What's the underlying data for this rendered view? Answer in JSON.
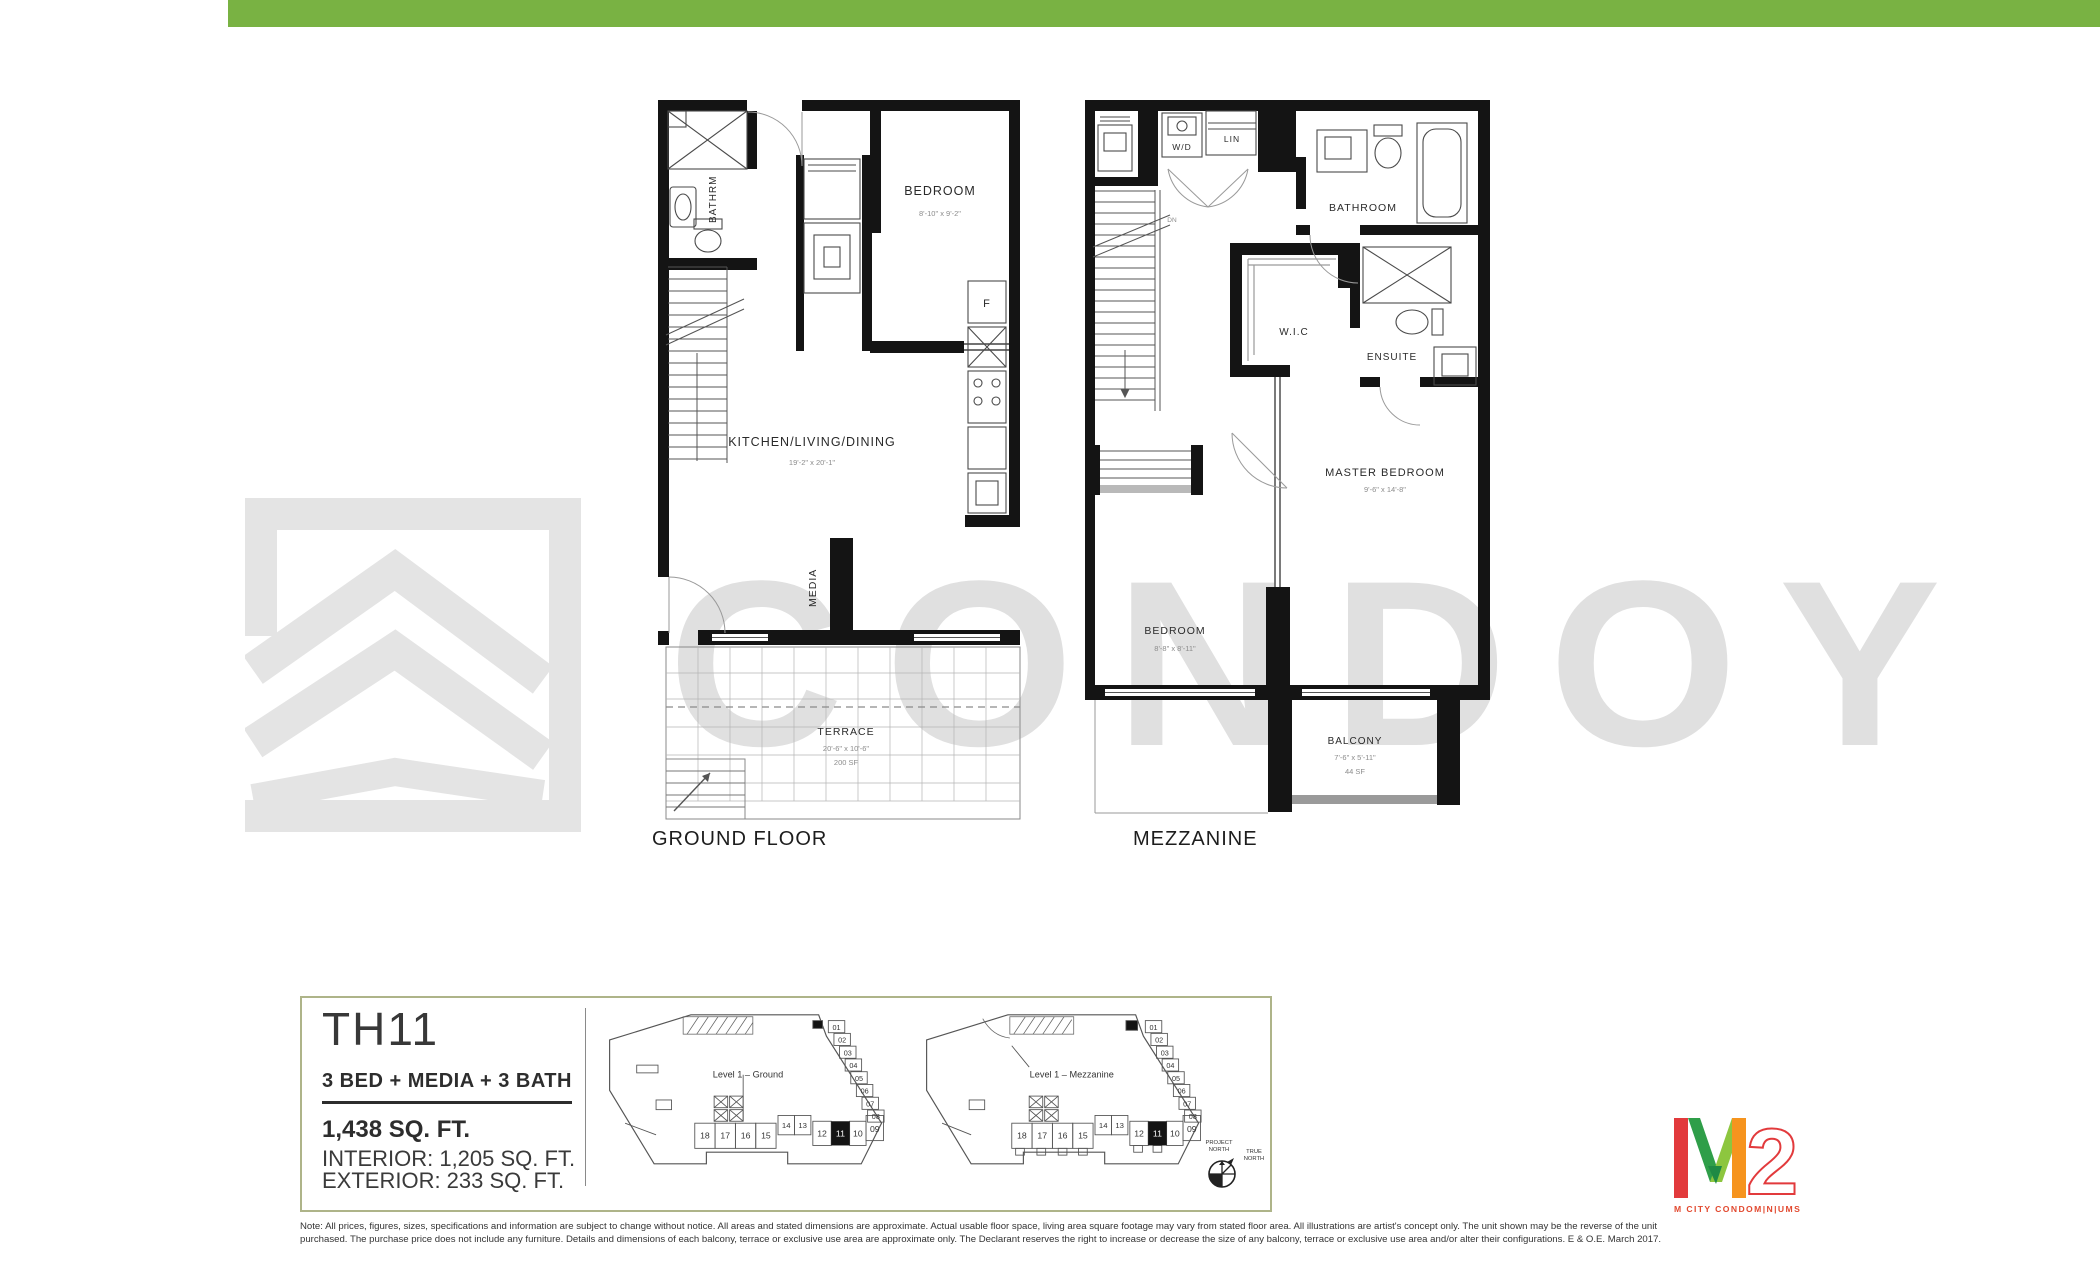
{
  "header": {
    "bar_color": "#79b243"
  },
  "watermark": {
    "text": "CONDOY",
    "color": "#e0e0e0"
  },
  "plans": {
    "ground": {
      "caption": "GROUND FLOOR",
      "rooms": {
        "bathroom": "BATHRM",
        "bedroom": "BEDROOM",
        "bedroom_dim": "8'-10\" x 9'-2\"",
        "kitchen": "KITCHEN/LIVING/DINING",
        "kitchen_dim": "19'-2\" x 20'-1\"",
        "media": "MEDIA",
        "fridge": "F",
        "terrace": "TERRACE",
        "terrace_dim": "20'-6\" x 10'-6\"",
        "terrace_area": "200 SF"
      }
    },
    "mezzanine": {
      "caption": "MEZZANINE",
      "rooms": {
        "wd": "W/D",
        "lin": "LIN",
        "dn": "DN",
        "bathroom": "BATHROOM",
        "wic": "W.I.C",
        "ensuite": "ENSUITE",
        "master": "MASTER BEDROOM",
        "master_dim": "9'-6\" x 14'-8\"",
        "bedroom": "BEDROOM",
        "bedroom_dim": "8'-8\" x 8'-11\"",
        "balcony": "BALCONY",
        "balcony_dim": "7'-6\" x 5'-11\"",
        "balcony_area": "44 SF"
      }
    }
  },
  "info": {
    "unit": "TH11",
    "config": "3 BED + MEDIA + 3 BATH",
    "total": "1,438 SQ. FT.",
    "interior": "INTERIOR: 1,205 SQ. FT.",
    "exterior": "EXTERIOR: 233 SQ. FT."
  },
  "keyplans": {
    "ground_label": "Level 1 – Ground",
    "mezzanine_label": "Level 1 – Mezzanine",
    "highlighted_unit": "11",
    "units_diagonal": [
      "01",
      "02",
      "03",
      "04",
      "05",
      "06",
      "07",
      "08"
    ],
    "units_row": [
      "18",
      "17",
      "16",
      "15",
      "14",
      "13",
      "12",
      "11",
      "10",
      "09"
    ],
    "compass": {
      "project_line1": "PROJECT",
      "project_line2": "NORTH",
      "true_line1": "TRUE",
      "true_line2": "NORTH"
    }
  },
  "logo": {
    "two": "2",
    "tagline": "M CITY CONDOM|N|UMS",
    "colors": {
      "red": "#e23a3c",
      "dark_green": "#2f9e49",
      "light_green": "#8dc63f",
      "orange": "#f6941e"
    }
  },
  "disclaimer": {
    "line1": "Note: All prices, figures, sizes, specifications and information are subject to change without notice. All areas and stated dimensions are approximate. Actual usable floor space, living area square footage may vary from stated floor area. All illustrations are artist's concept only. The unit shown may be the reverse of the unit",
    "line2": "purchased. The purchase price does not include any furniture. Details and dimensions of each balcony, terrace or exclusive use area are approximate only. The Declarant reserves the right to increase or decrease the size of any balcony, terrace or exclusive use area and/or alter their configurations. E & O.E. March 2017."
  }
}
